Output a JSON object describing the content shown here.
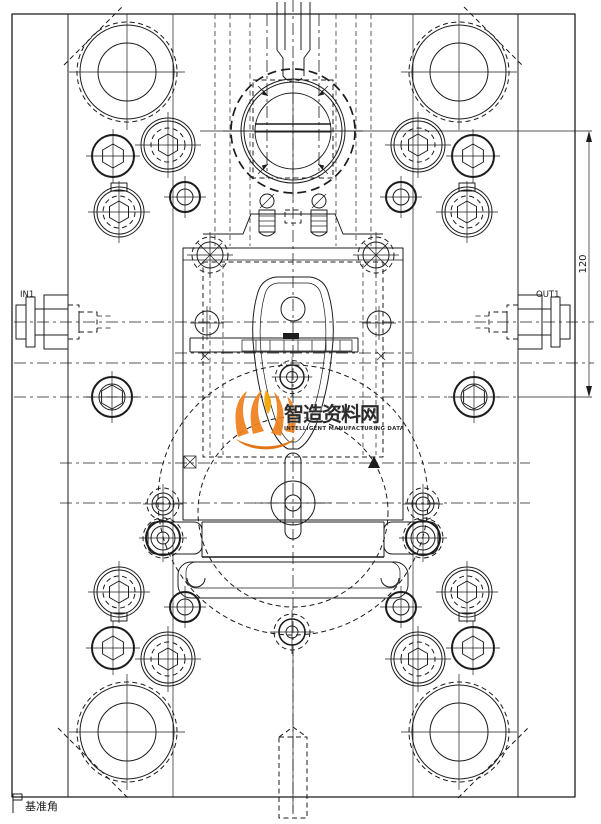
{
  "drawing": {
    "labels": {
      "inlet": "IN1",
      "outlet": "OUT1",
      "datum": "基准角"
    },
    "dimension": {
      "value": "120"
    },
    "watermark": {
      "title": "智造资料网",
      "subtitle": "INTELLIGENT MANUFACTURING DATA",
      "color": "#f08300"
    },
    "colors": {
      "line": "#1c1c1c",
      "background": "#ffffff"
    }
  }
}
